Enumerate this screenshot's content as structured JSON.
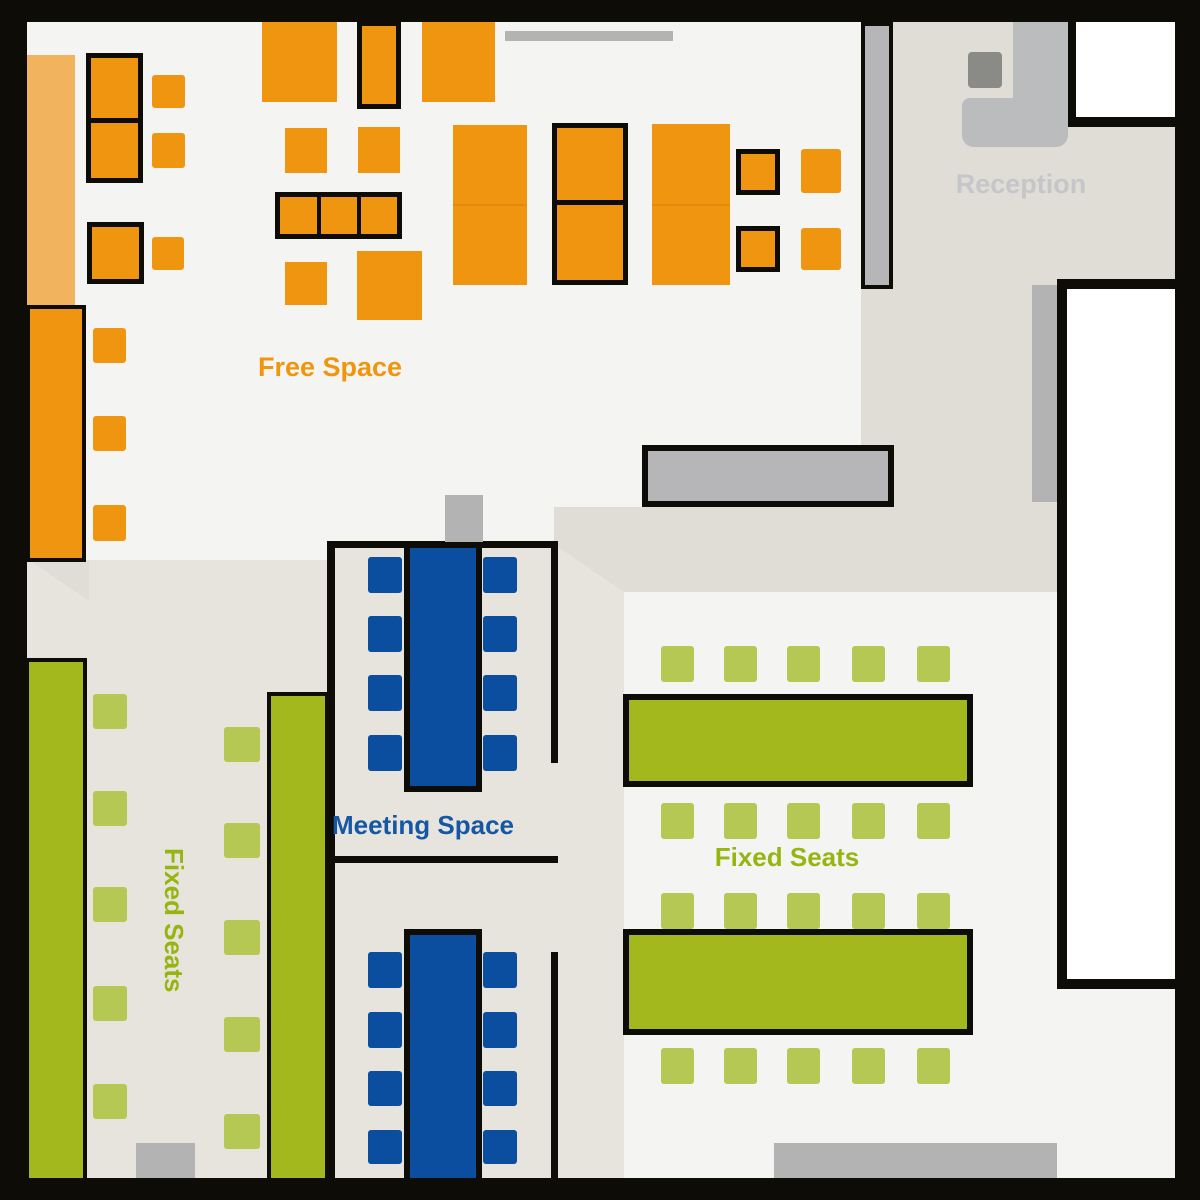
{
  "labels": {
    "free_space": {
      "text": "Free Space",
      "color": "#f0960e"
    },
    "reception": {
      "text": "Reception",
      "color": "#c6c5c9"
    },
    "meeting_space": {
      "text": "Meeting Space",
      "color": "#1557a4"
    },
    "fixed_seats_right": {
      "text": "Fixed Seats",
      "color": "#97b511"
    },
    "fixed_seats_left": {
      "text": "Fixed Seats",
      "color": "#97b511"
    }
  },
  "colors": {
    "wall": "#0d0c07",
    "fl": "#f4f4f3",
    "bl": "#e7e4dd",
    "bd": "#e0ddd6",
    "or": "#ef950f",
    "op": "#f1b35d",
    "os": "#e08a0e",
    "gr": "#a3b81c",
    "gl": "#b6c854",
    "bu": "#0b4d9e",
    "gm": "#b6b6b8",
    "gd": "#b3b3b4",
    "gk": "#bbbcbe",
    "gc": "#8a8a86",
    "wh": "#ffffff"
  },
  "shapes": [
    {
      "n": "floor-main",
      "x": 27,
      "y": 22,
      "w": 1148,
      "h": 1156,
      "c": "fl"
    },
    {
      "n": "floor-fixed-seats-left",
      "x": 27,
      "y": 560,
      "w": 303,
      "h": 618,
      "c": "bl"
    },
    {
      "n": "floor-meeting-area",
      "x": 327,
      "y": 541,
      "w": 297,
      "h": 637,
      "c": "bl"
    },
    {
      "n": "floor-corridor-wedge",
      "x": 29,
      "y": 560,
      "w": 60,
      "h": 41,
      "c": "bd",
      "clip": "polygon(0 0,100% 0,100% 100%)"
    },
    {
      "n": "floor-corridor-band",
      "x": 554,
      "y": 507,
      "w": 509,
      "h": 85,
      "c": "bd",
      "clip": "polygon(0 0,100% 0,100% 100%,13.7% 100%,0 44%)"
    },
    {
      "n": "floor-reception-corridor",
      "x": 861,
      "y": 22,
      "w": 314,
      "h": 570,
      "c": "bd"
    },
    {
      "n": "meeting-wall-left",
      "x": 327,
      "y": 541,
      "w": 8,
      "h": 637,
      "c": "wall"
    },
    {
      "n": "meeting-wall-top",
      "x": 327,
      "y": 541,
      "w": 231,
      "h": 7,
      "c": "wall"
    },
    {
      "n": "meeting-wall-right-upper",
      "x": 551,
      "y": 541,
      "w": 7,
      "h": 222,
      "c": "wall"
    },
    {
      "n": "meeting-wall-middle",
      "x": 331,
      "y": 856,
      "w": 227,
      "h": 7,
      "c": "wall"
    },
    {
      "n": "meeting-wall-right-lower",
      "x": 551,
      "y": 952,
      "w": 7,
      "h": 226,
      "c": "wall"
    },
    {
      "n": "door-top",
      "x": 505,
      "y": 31,
      "w": 168,
      "h": 10,
      "c": "gd"
    },
    {
      "n": "door-meeting-room",
      "x": 445,
      "y": 495,
      "w": 38,
      "h": 47,
      "c": "gd"
    },
    {
      "n": "door-strip-right-room",
      "x": 1032,
      "y": 285,
      "w": 28,
      "h": 217,
      "c": "gd"
    },
    {
      "n": "door-bottom-left",
      "x": 136,
      "y": 1143,
      "w": 59,
      "h": 35,
      "c": "gd"
    },
    {
      "n": "door-bottom-right",
      "x": 774,
      "y": 1143,
      "w": 283,
      "h": 35,
      "c": "gd"
    },
    {
      "n": "free-space-counter-pale",
      "x": 27,
      "y": 55,
      "w": 48,
      "h": 250,
      "c": "op"
    },
    {
      "n": "free-space-counter-border",
      "x": 26,
      "y": 305,
      "w": 60,
      "h": 257,
      "c": "wall"
    },
    {
      "n": "free-space-counter",
      "x": 30,
      "y": 309,
      "w": 52,
      "h": 249,
      "c": "or"
    },
    {
      "n": "desk-group-border",
      "x": 86,
      "y": 53,
      "w": 57,
      "h": 130,
      "c": "wall"
    },
    {
      "n": "desk",
      "x": 91,
      "y": 58,
      "w": 47,
      "h": 60,
      "c": "or"
    },
    {
      "n": "desk",
      "x": 91,
      "y": 123,
      "w": 47,
      "h": 55,
      "c": "or"
    },
    {
      "n": "chair",
      "x": 152,
      "y": 75,
      "w": 33,
      "h": 33,
      "c": "or",
      "r": 3
    },
    {
      "n": "chair",
      "x": 152,
      "y": 133,
      "w": 33,
      "h": 35,
      "c": "or",
      "r": 3
    },
    {
      "n": "desk-border",
      "x": 87,
      "y": 222,
      "w": 57,
      "h": 62,
      "c": "wall"
    },
    {
      "n": "desk",
      "x": 92,
      "y": 227,
      "w": 47,
      "h": 52,
      "c": "or"
    },
    {
      "n": "chair",
      "x": 152,
      "y": 237,
      "w": 32,
      "h": 33,
      "c": "or",
      "r": 3
    },
    {
      "n": "chair",
      "x": 93,
      "y": 328,
      "w": 33,
      "h": 35,
      "c": "or",
      "r": 3
    },
    {
      "n": "chair",
      "x": 93,
      "y": 416,
      "w": 33,
      "h": 35,
      "c": "or",
      "r": 3
    },
    {
      "n": "chair",
      "x": 93,
      "y": 505,
      "w": 33,
      "h": 36,
      "c": "or",
      "r": 3
    },
    {
      "n": "desk",
      "x": 262,
      "y": 22,
      "w": 75,
      "h": 80,
      "c": "or"
    },
    {
      "n": "desk-border",
      "x": 357,
      "y": 21,
      "w": 44,
      "h": 88,
      "c": "wall"
    },
    {
      "n": "desk",
      "x": 362,
      "y": 26,
      "w": 34,
      "h": 78,
      "c": "or"
    },
    {
      "n": "desk",
      "x": 422,
      "y": 22,
      "w": 73,
      "h": 80,
      "c": "or"
    },
    {
      "n": "desk",
      "x": 285,
      "y": 128,
      "w": 42,
      "h": 45,
      "c": "or"
    },
    {
      "n": "desk",
      "x": 358,
      "y": 127,
      "w": 42,
      "h": 46,
      "c": "or"
    },
    {
      "n": "desk-group-border",
      "x": 275,
      "y": 192,
      "w": 127,
      "h": 47,
      "c": "wall"
    },
    {
      "n": "desk",
      "x": 280,
      "y": 197,
      "w": 37,
      "h": 37,
      "c": "or"
    },
    {
      "n": "desk",
      "x": 321,
      "y": 197,
      "w": 36,
      "h": 37,
      "c": "or"
    },
    {
      "n": "desk",
      "x": 361,
      "y": 197,
      "w": 36,
      "h": 37,
      "c": "or"
    },
    {
      "n": "desk",
      "x": 285,
      "y": 262,
      "w": 42,
      "h": 43,
      "c": "or"
    },
    {
      "n": "desk",
      "x": 357,
      "y": 251,
      "w": 65,
      "h": 69,
      "c": "or"
    },
    {
      "n": "desk-double",
      "x": 453,
      "y": 125,
      "w": 74,
      "h": 160,
      "c": "or"
    },
    {
      "n": "desk-seam",
      "x": 453,
      "y": 204,
      "w": 74,
      "h": 2,
      "c": "os"
    },
    {
      "n": "desk-group-border",
      "x": 552,
      "y": 123,
      "w": 76,
      "h": 162,
      "c": "wall"
    },
    {
      "n": "desk",
      "x": 557,
      "y": 128,
      "w": 66,
      "h": 72,
      "c": "or"
    },
    {
      "n": "desk",
      "x": 557,
      "y": 205,
      "w": 66,
      "h": 75,
      "c": "or"
    },
    {
      "n": "desk-double",
      "x": 652,
      "y": 124,
      "w": 78,
      "h": 161,
      "c": "or"
    },
    {
      "n": "desk-seam",
      "x": 652,
      "y": 204,
      "w": 78,
      "h": 2,
      "c": "os"
    },
    {
      "n": "desk-border",
      "x": 736,
      "y": 149,
      "w": 44,
      "h": 46,
      "c": "wall"
    },
    {
      "n": "desk",
      "x": 741,
      "y": 154,
      "w": 34,
      "h": 36,
      "c": "or"
    },
    {
      "n": "desk-border",
      "x": 736,
      "y": 226,
      "w": 44,
      "h": 46,
      "c": "wall"
    },
    {
      "n": "desk",
      "x": 741,
      "y": 231,
      "w": 34,
      "h": 36,
      "c": "or"
    },
    {
      "n": "chair",
      "x": 801,
      "y": 149,
      "w": 40,
      "h": 44,
      "c": "or",
      "r": 3
    },
    {
      "n": "chair",
      "x": 801,
      "y": 228,
      "w": 40,
      "h": 42,
      "c": "or",
      "r": 3
    },
    {
      "n": "partition-border",
      "x": 861,
      "y": 22,
      "w": 32,
      "h": 267,
      "c": "wall"
    },
    {
      "n": "partition",
      "x": 865,
      "y": 26,
      "w": 24,
      "h": 259,
      "c": "gm"
    },
    {
      "n": "counter-border",
      "x": 642,
      "y": 445,
      "w": 252,
      "h": 62,
      "c": "wall"
    },
    {
      "n": "counter",
      "x": 648,
      "y": 451,
      "w": 240,
      "h": 50,
      "c": "gm"
    },
    {
      "n": "meeting-table-border",
      "x": 404,
      "y": 542,
      "w": 78,
      "h": 250,
      "c": "wall"
    },
    {
      "n": "meeting-table",
      "x": 410,
      "y": 548,
      "w": 66,
      "h": 238,
      "c": "bu"
    },
    {
      "n": "chair",
      "x": 368,
      "y": 557,
      "w": 34,
      "h": 36,
      "c": "bu",
      "r": 3
    },
    {
      "n": "chair",
      "x": 368,
      "y": 616,
      "w": 34,
      "h": 36,
      "c": "bu",
      "r": 3
    },
    {
      "n": "chair",
      "x": 368,
      "y": 675,
      "w": 34,
      "h": 36,
      "c": "bu",
      "r": 3
    },
    {
      "n": "chair",
      "x": 368,
      "y": 735,
      "w": 34,
      "h": 36,
      "c": "bu",
      "r": 3
    },
    {
      "n": "chair",
      "x": 483,
      "y": 557,
      "w": 34,
      "h": 36,
      "c": "bu",
      "r": 3
    },
    {
      "n": "chair",
      "x": 483,
      "y": 616,
      "w": 34,
      "h": 36,
      "c": "bu",
      "r": 3
    },
    {
      "n": "chair",
      "x": 483,
      "y": 675,
      "w": 34,
      "h": 36,
      "c": "bu",
      "r": 3
    },
    {
      "n": "chair",
      "x": 483,
      "y": 735,
      "w": 34,
      "h": 36,
      "c": "bu",
      "r": 3
    },
    {
      "n": "meeting-table-border",
      "x": 404,
      "y": 929,
      "w": 78,
      "h": 249,
      "c": "wall"
    },
    {
      "n": "meeting-table",
      "x": 410,
      "y": 935,
      "w": 66,
      "h": 243,
      "c": "bu"
    },
    {
      "n": "chair",
      "x": 368,
      "y": 952,
      "w": 34,
      "h": 36,
      "c": "bu",
      "r": 3
    },
    {
      "n": "chair",
      "x": 368,
      "y": 1012,
      "w": 34,
      "h": 36,
      "c": "bu",
      "r": 3
    },
    {
      "n": "chair",
      "x": 368,
      "y": 1071,
      "w": 34,
      "h": 35,
      "c": "bu",
      "r": 3
    },
    {
      "n": "chair",
      "x": 368,
      "y": 1130,
      "w": 34,
      "h": 34,
      "c": "bu",
      "r": 3
    },
    {
      "n": "chair",
      "x": 483,
      "y": 952,
      "w": 34,
      "h": 36,
      "c": "bu",
      "r": 3
    },
    {
      "n": "chair",
      "x": 483,
      "y": 1012,
      "w": 34,
      "h": 36,
      "c": "bu",
      "r": 3
    },
    {
      "n": "chair",
      "x": 483,
      "y": 1071,
      "w": 34,
      "h": 35,
      "c": "bu",
      "r": 3
    },
    {
      "n": "chair",
      "x": 483,
      "y": 1130,
      "w": 34,
      "h": 34,
      "c": "bu",
      "r": 3
    },
    {
      "n": "fixed-table-border",
      "x": 25,
      "y": 658,
      "w": 62,
      "h": 520,
      "c": "wall"
    },
    {
      "n": "fixed-table",
      "x": 29,
      "y": 662,
      "w": 54,
      "h": 516,
      "c": "gr"
    },
    {
      "n": "fixed-table-border",
      "x": 267,
      "y": 692,
      "w": 62,
      "h": 486,
      "c": "wall"
    },
    {
      "n": "fixed-table",
      "x": 271,
      "y": 696,
      "w": 54,
      "h": 482,
      "c": "gr"
    },
    {
      "n": "chair",
      "x": 93,
      "y": 694,
      "w": 34,
      "h": 35,
      "c": "gl",
      "r": 3
    },
    {
      "n": "chair",
      "x": 93,
      "y": 791,
      "w": 34,
      "h": 35,
      "c": "gl",
      "r": 3
    },
    {
      "n": "chair",
      "x": 93,
      "y": 887,
      "w": 34,
      "h": 35,
      "c": "gl",
      "r": 3
    },
    {
      "n": "chair",
      "x": 93,
      "y": 986,
      "w": 34,
      "h": 35,
      "c": "gl",
      "r": 3
    },
    {
      "n": "chair",
      "x": 93,
      "y": 1084,
      "w": 34,
      "h": 35,
      "c": "gl",
      "r": 3
    },
    {
      "n": "chair",
      "x": 224,
      "y": 727,
      "w": 36,
      "h": 35,
      "c": "gl",
      "r": 3
    },
    {
      "n": "chair",
      "x": 224,
      "y": 823,
      "w": 36,
      "h": 35,
      "c": "gl",
      "r": 3
    },
    {
      "n": "chair",
      "x": 224,
      "y": 920,
      "w": 36,
      "h": 35,
      "c": "gl",
      "r": 3
    },
    {
      "n": "chair",
      "x": 224,
      "y": 1017,
      "w": 36,
      "h": 35,
      "c": "gl",
      "r": 3
    },
    {
      "n": "chair",
      "x": 224,
      "y": 1114,
      "w": 36,
      "h": 35,
      "c": "gl",
      "r": 3
    },
    {
      "n": "fixed-table-border",
      "x": 623,
      "y": 694,
      "w": 350,
      "h": 93,
      "c": "wall"
    },
    {
      "n": "fixed-table",
      "x": 629,
      "y": 700,
      "w": 338,
      "h": 81,
      "c": "gr"
    },
    {
      "n": "fixed-table-border",
      "x": 623,
      "y": 929,
      "w": 350,
      "h": 106,
      "c": "wall"
    },
    {
      "n": "fixed-table",
      "x": 629,
      "y": 935,
      "w": 338,
      "h": 94,
      "c": "gr"
    },
    {
      "n": "chair",
      "x": 661,
      "y": 646,
      "w": 33,
      "h": 36,
      "c": "gl",
      "r": 3
    },
    {
      "n": "chair",
      "x": 724,
      "y": 646,
      "w": 33,
      "h": 36,
      "c": "gl",
      "r": 3
    },
    {
      "n": "chair",
      "x": 787,
      "y": 646,
      "w": 33,
      "h": 36,
      "c": "gl",
      "r": 3
    },
    {
      "n": "chair",
      "x": 852,
      "y": 646,
      "w": 33,
      "h": 36,
      "c": "gl",
      "r": 3
    },
    {
      "n": "chair",
      "x": 917,
      "y": 646,
      "w": 33,
      "h": 36,
      "c": "gl",
      "r": 3
    },
    {
      "n": "chair",
      "x": 661,
      "y": 803,
      "w": 33,
      "h": 36,
      "c": "gl",
      "r": 3
    },
    {
      "n": "chair",
      "x": 724,
      "y": 803,
      "w": 33,
      "h": 36,
      "c": "gl",
      "r": 3
    },
    {
      "n": "chair",
      "x": 787,
      "y": 803,
      "w": 33,
      "h": 36,
      "c": "gl",
      "r": 3
    },
    {
      "n": "chair",
      "x": 852,
      "y": 803,
      "w": 33,
      "h": 36,
      "c": "gl",
      "r": 3
    },
    {
      "n": "chair",
      "x": 917,
      "y": 803,
      "w": 33,
      "h": 36,
      "c": "gl",
      "r": 3
    },
    {
      "n": "chair",
      "x": 661,
      "y": 893,
      "w": 33,
      "h": 36,
      "c": "gl",
      "r": 3
    },
    {
      "n": "chair",
      "x": 724,
      "y": 893,
      "w": 33,
      "h": 36,
      "c": "gl",
      "r": 3
    },
    {
      "n": "chair",
      "x": 787,
      "y": 893,
      "w": 33,
      "h": 36,
      "c": "gl",
      "r": 3
    },
    {
      "n": "chair",
      "x": 852,
      "y": 893,
      "w": 33,
      "h": 36,
      "c": "gl",
      "r": 3
    },
    {
      "n": "chair",
      "x": 917,
      "y": 893,
      "w": 33,
      "h": 36,
      "c": "gl",
      "r": 3
    },
    {
      "n": "chair",
      "x": 661,
      "y": 1048,
      "w": 33,
      "h": 36,
      "c": "gl",
      "r": 3
    },
    {
      "n": "chair",
      "x": 724,
      "y": 1048,
      "w": 33,
      "h": 36,
      "c": "gl",
      "r": 3
    },
    {
      "n": "chair",
      "x": 787,
      "y": 1048,
      "w": 33,
      "h": 36,
      "c": "gl",
      "r": 3
    },
    {
      "n": "chair",
      "x": 852,
      "y": 1048,
      "w": 33,
      "h": 36,
      "c": "gl",
      "r": 3
    },
    {
      "n": "chair",
      "x": 917,
      "y": 1048,
      "w": 33,
      "h": 36,
      "c": "gl",
      "r": 3
    },
    {
      "n": "room-wall",
      "x": 1066,
      "y": 22,
      "w": 110,
      "h": 105,
      "c": "wall"
    },
    {
      "n": "room",
      "x": 1076,
      "y": 22,
      "w": 100,
      "h": 95,
      "c": "wh"
    },
    {
      "n": "room-wall",
      "x": 1057,
      "y": 279,
      "w": 118,
      "h": 710,
      "c": "wall"
    },
    {
      "n": "room",
      "x": 1067,
      "y": 289,
      "w": 108,
      "h": 690,
      "c": "wh"
    },
    {
      "n": "reception-desk",
      "x": 1013,
      "y": 22,
      "w": 55,
      "h": 86,
      "c": "gk"
    },
    {
      "n": "reception-desk",
      "x": 962,
      "y": 98,
      "w": 106,
      "h": 49,
      "c": "gk",
      "r": "8px 0 12px 12px"
    },
    {
      "n": "reception-chair",
      "x": 968,
      "y": 52,
      "w": 34,
      "h": 36,
      "c": "gc",
      "r": 4
    },
    {
      "n": "outer-wall-top",
      "x": 0,
      "y": 0,
      "w": 1200,
      "h": 22,
      "c": "wall"
    },
    {
      "n": "outer-wall-left",
      "x": 0,
      "y": 0,
      "w": 27,
      "h": 1200,
      "c": "wall"
    },
    {
      "n": "outer-wall-right",
      "x": 1175,
      "y": 0,
      "w": 25,
      "h": 1200,
      "c": "wall"
    },
    {
      "n": "outer-wall-bottom",
      "x": 0,
      "y": 1178,
      "w": 1200,
      "h": 22,
      "c": "wall"
    }
  ]
}
